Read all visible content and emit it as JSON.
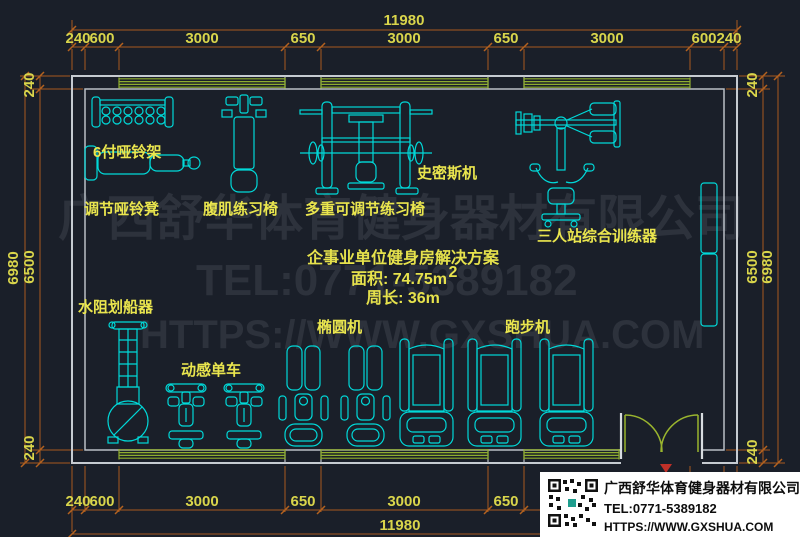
{
  "drawing": {
    "background": "#1a1f29",
    "colors": {
      "wall": "#c6cbd1",
      "inner_wall": "#b9bfc6",
      "window_band": "#8fae2e",
      "door": "#9ab52e",
      "equipment": "#00d9d9",
      "label_text": "#eae64e",
      "dimension_line": "#a85a1f",
      "dimension_text": "#d9d54b",
      "watermark": "#2d323c",
      "marker_red": "#c03028"
    }
  },
  "dimensions": {
    "top_total": "11980",
    "bottom_total": "11980",
    "top_segments": [
      "240",
      "600",
      "3000",
      "650",
      "3000",
      "650",
      "3000",
      "600",
      "240"
    ],
    "bottom_segments": [
      "240",
      "600",
      "3000",
      "650",
      "3000",
      "650"
    ],
    "left_total": "6980",
    "left_segments": [
      "240",
      "6500",
      "240"
    ],
    "right_segments": [
      "240",
      "6500",
      "240"
    ],
    "right_total": "6980"
  },
  "equipment_labels": {
    "dumbbell_rack": "6付哑铃架",
    "dumbbell_bench": "调节哑铃凳",
    "ab_chair": "腹肌练习椅",
    "multi_bench": "多重可调节练习椅",
    "smith_machine": "史密斯机",
    "multi_station": "三人站综合训练器",
    "rower": "水阻划船器",
    "spin_bike": "动感单车",
    "elliptical": "椭圆机",
    "treadmill": "跑步机"
  },
  "solution": {
    "title": "企事业单位健身房解决方案",
    "area": "面积: 74.75m",
    "area_sup": "2",
    "perimeter": "周长: 36m"
  },
  "watermark": {
    "company": "广西舒华体育健身器材有限公司",
    "tel": "TEL:0771-5389182",
    "website": "HTTPS://WWW.GXSHUA.COM"
  },
  "info_box": {
    "company": "广西舒华体育健身器材有限公司",
    "tel": "TEL:0771-5389182",
    "website": "HTTPS://WWW.GXSHUA.COM",
    "qr": "qr-code"
  }
}
